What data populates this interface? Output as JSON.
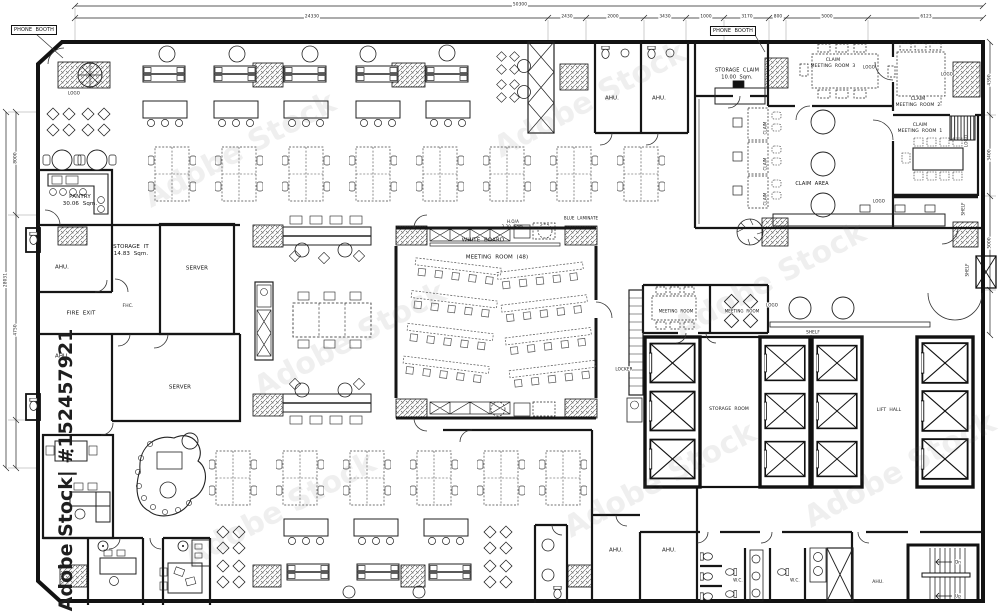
{
  "labels": {
    "phone_booth": "PHONE  BOOTH",
    "pantry": "PANTRY",
    "pantry_area": "30.06  Sqm.",
    "storage_it": "STORAGE  IT",
    "storage_it_area": "14.83  Sqm.",
    "ahu": "AHU.",
    "fire_exit": "FIRE  EXIT",
    "fhc": "FHC.",
    "server": "SERVER",
    "white_board": "WHITE  BOARD",
    "meeting_room_48": "MEETING  ROOM  (48)",
    "hoa": "H.O/A",
    "hoa_area": "2.20  Sqm.",
    "blue_laminate": "BLUE  LAMINATE",
    "storage_claim": "STORAGE  CLAIM",
    "storage_claim_area": "10.00  Sqm.",
    "claim": "CLAIM",
    "claim_meeting_room_3": "MEETING  ROOM  3",
    "claim_meeting_room_2": "MEETING  ROOM  2",
    "claim_meeting_room_1": "MEETING  ROOM  1",
    "claim_area": "CLAIM  AREA",
    "logo": "LOGO",
    "shelf": "SHELF",
    "locker": "LOCKER",
    "meeting_room": "MEETING  ROOM",
    "storage_room": "STORAGE  ROOM",
    "lift_hall": "LIFT  HALL",
    "wc": "W.C.",
    "dn": "Dn",
    "up": "Up"
  },
  "dimensions": {
    "top_overall": "50300",
    "top": [
      "24330",
      "2430",
      "2000",
      "3430",
      "1000",
      "3170",
      "800",
      "5000",
      "6123"
    ],
    "left": [
      "8000",
      "4750",
      "28031"
    ],
    "right": [
      "4390",
      "3400",
      "5000"
    ]
  },
  "watermark": {
    "brand": "Adobe Stock",
    "side_text": "Adobe Stock| #152457921"
  }
}
